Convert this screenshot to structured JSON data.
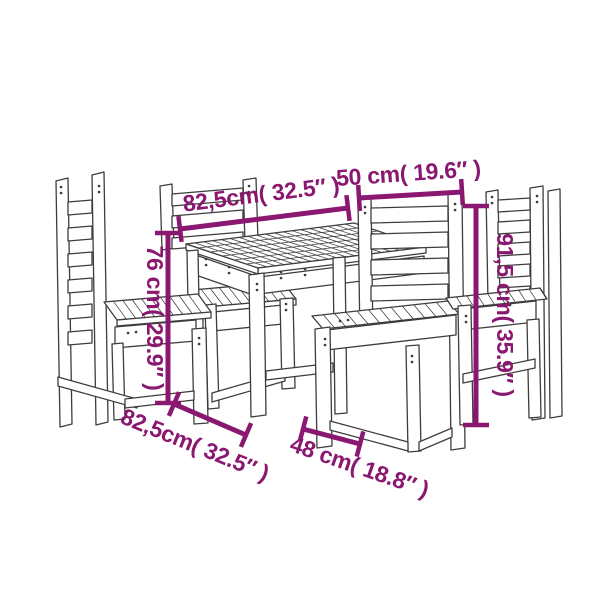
{
  "figure": {
    "type": "product-dimensions-line-drawing",
    "background": "#ffffff",
    "line_color": "#3d3d3d",
    "dimension_color": "#8a1770"
  },
  "furniture": {
    "pieces": [
      "side chair left",
      "chair behind table",
      "square slatted table",
      "chair front right",
      "side chair right"
    ]
  },
  "dimensions": {
    "table_width_top": {
      "label": "82,5cm( 32.5″ )",
      "cm": "82,5",
      "inches": "32.5"
    },
    "chair_back_width": {
      "label": "50 cm( 19.6″ )",
      "cm": "50",
      "inches": "19.6"
    },
    "table_height": {
      "label": "76 cm( 29.9″ )",
      "cm": "76",
      "inches": "29.9"
    },
    "chair_height": {
      "label": "91,5 cm( 35.9″ )",
      "cm": "91,5",
      "inches": "35.9"
    },
    "table_width_bottom": {
      "label": "82,5cm( 32.5″ )",
      "cm": "82,5",
      "inches": "32.5"
    },
    "chair_depth": {
      "label": "48 cm( 18.8″ )",
      "cm": "48",
      "inches": "18.8"
    }
  }
}
